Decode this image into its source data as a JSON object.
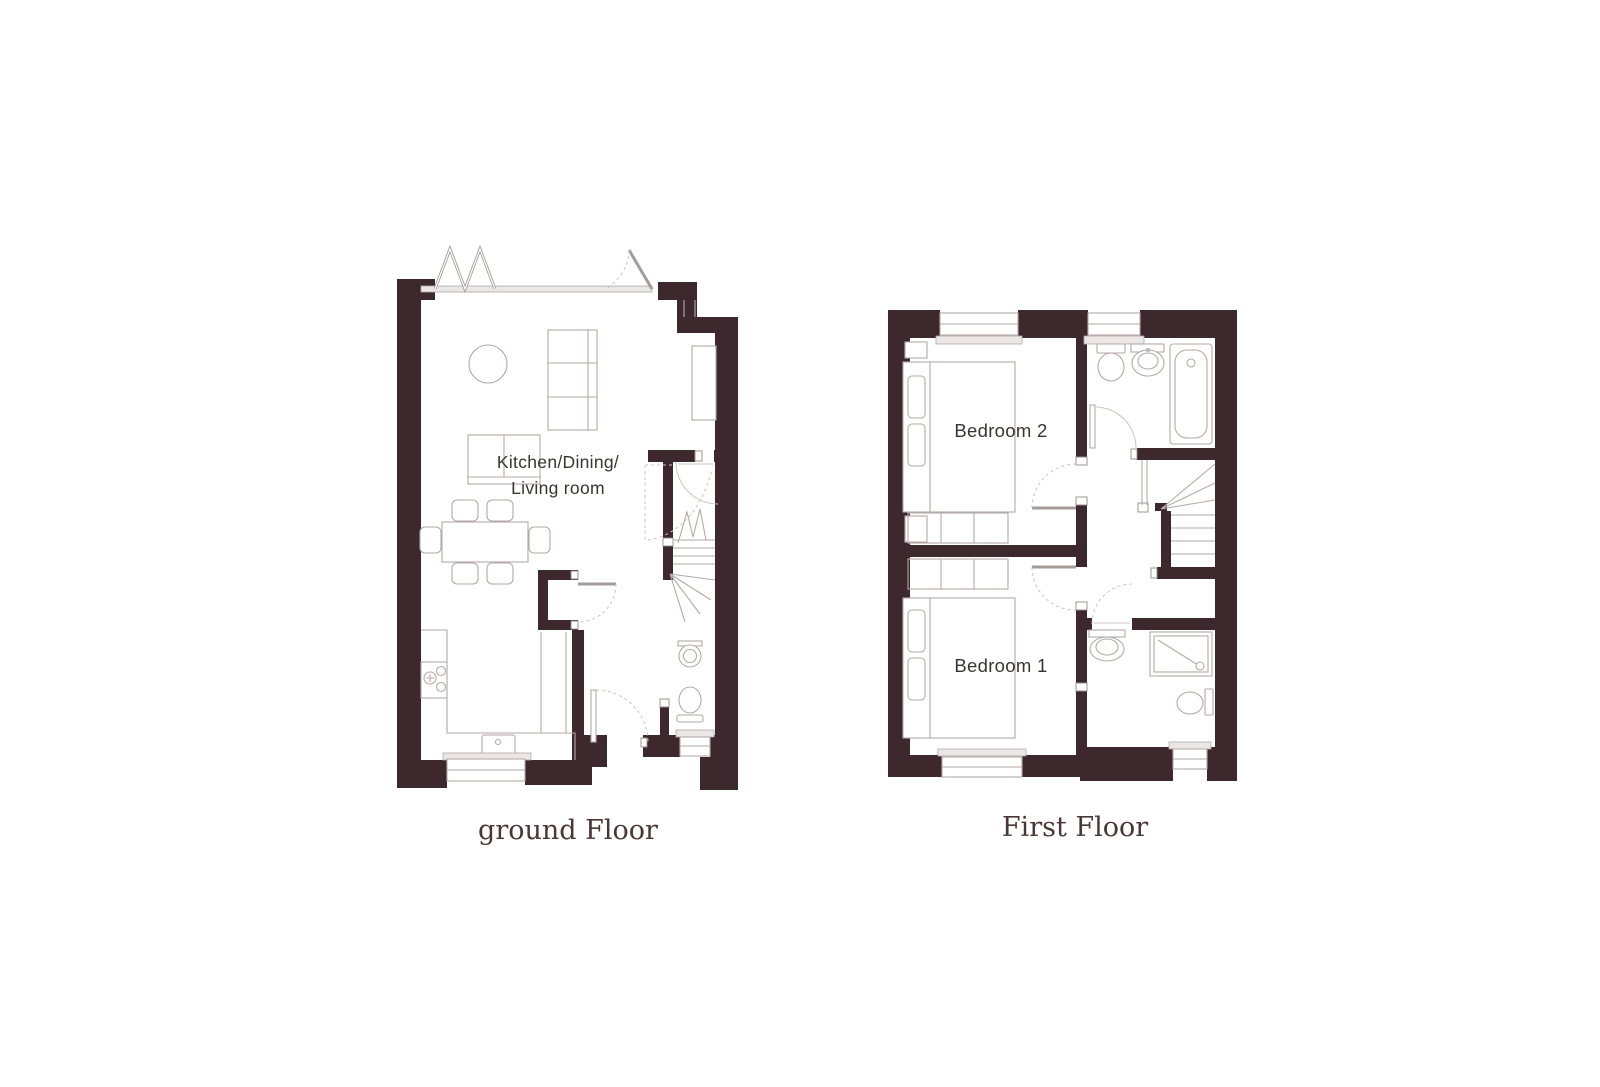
{
  "colors": {
    "wall": "#3d282d",
    "line": "#b3aaa7",
    "line-strong": "#938a87",
    "arc": "#cbc4c1",
    "sill": "#eae7e5",
    "room-label": "#3a3431",
    "caption": "#4a3733",
    "bg": "#ffffff"
  },
  "plans": {
    "ground": {
      "caption": "ground Floor",
      "room_label_line1": "Kitchen/Dining/",
      "room_label_line2": "Living room",
      "features": [
        "bifold-doors",
        "entrance-door",
        "round-table",
        "sofa",
        "loveseat",
        "dining-table-6-chairs",
        "kitchen-counter",
        "hob",
        "kitchen-sink",
        "stairs",
        "wc-basin",
        "wc-toilet",
        "kitchen-window",
        "wc-window"
      ]
    },
    "first": {
      "caption": "First Floor",
      "bedroom2_label": "Bedroom 2",
      "bedroom1_label": "Bedroom 1",
      "features": [
        "bathroom-toilet",
        "bathroom-basin",
        "bathtub",
        "stairs",
        "landing",
        "wardrobes",
        "double-beds",
        "ensuite-basin",
        "shower",
        "ensuite-toilet",
        "windows"
      ]
    }
  }
}
